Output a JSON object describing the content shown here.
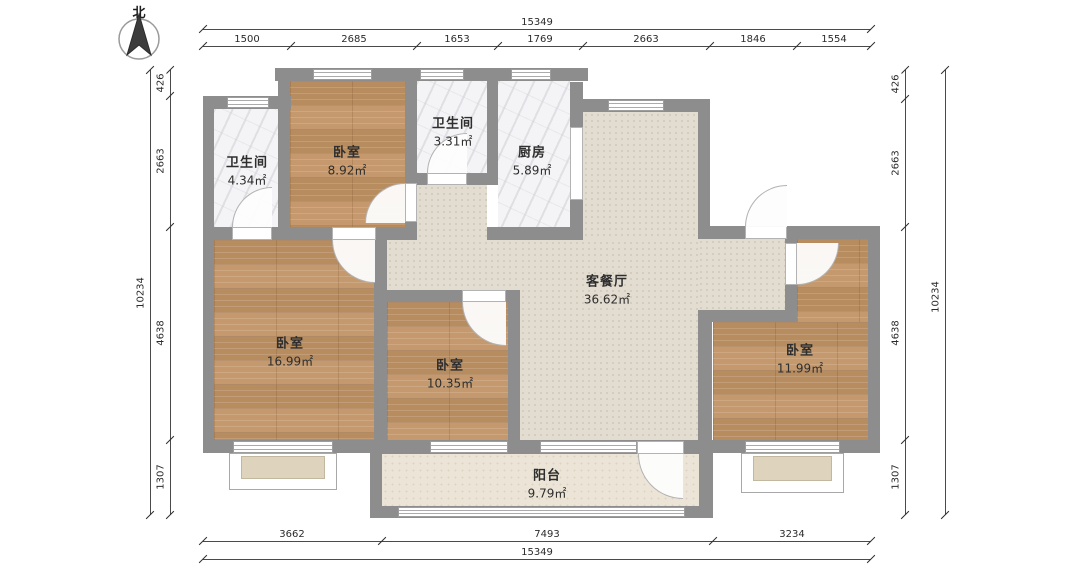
{
  "compass": {
    "label": "北"
  },
  "rooms": [
    {
      "id": "bath-left",
      "name": "卫生间",
      "area": "4.34㎡"
    },
    {
      "id": "bedroom-top",
      "name": "卧室",
      "area": "8.92㎡"
    },
    {
      "id": "bath-middle",
      "name": "卫生间",
      "area": "3.31㎡"
    },
    {
      "id": "kitchen",
      "name": "厨房",
      "area": "5.89㎡"
    },
    {
      "id": "living-dining",
      "name": "客餐厅",
      "area": "36.62㎡"
    },
    {
      "id": "bedroom-left",
      "name": "卧室",
      "area": "16.99㎡"
    },
    {
      "id": "bedroom-mid",
      "name": "卧室",
      "area": "10.35㎡"
    },
    {
      "id": "bedroom-right",
      "name": "卧室",
      "area": "11.99㎡"
    },
    {
      "id": "balcony",
      "name": "阳台",
      "area": "9.79㎡"
    }
  ],
  "dimensions": {
    "top": {
      "total": "15349",
      "segments": [
        "1500",
        "2685",
        "1653",
        "1769",
        "2663",
        "1846",
        "1554"
      ]
    },
    "bottom": {
      "total": "15349",
      "segments": [
        "3662",
        "7493",
        "3234"
      ]
    },
    "left": {
      "total": "10234",
      "segments": [
        "426",
        "2663",
        "4638",
        "1307"
      ]
    },
    "right": {
      "total": "10234",
      "segments": [
        "426",
        "2663",
        "4638",
        "1307"
      ]
    }
  },
  "colors": {
    "wall": "#8d8d8d",
    "wood": "#c19364",
    "tile": "#f4f4f6",
    "living": "#e3dcd0",
    "balcony": "#ece5d7"
  }
}
